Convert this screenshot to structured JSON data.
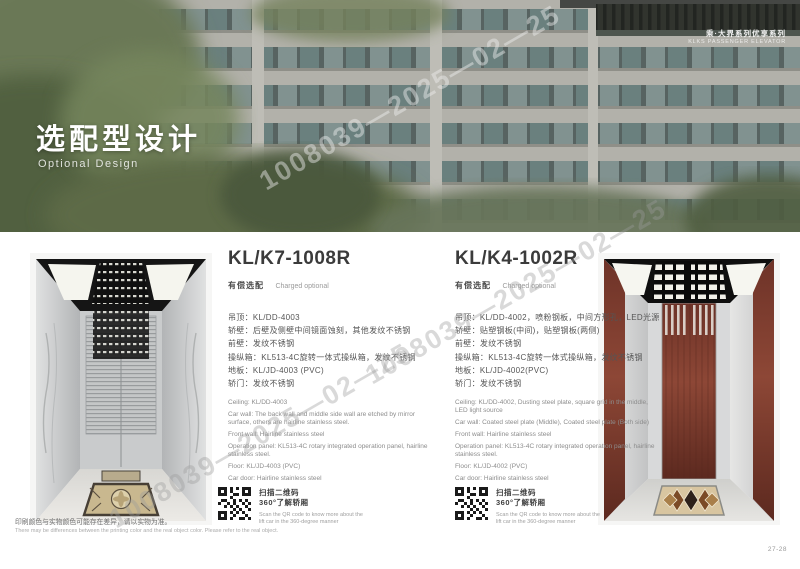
{
  "page": {
    "watermark": "1008039—2025—02—25",
    "page_number": "27-28",
    "disclaimer_zh": "印刷颜色与实物颜色可能存在差异，请以实物为准。",
    "disclaimer_en": "There may be differences between the printing color and the real object color. Please refer to the real object."
  },
  "hero": {
    "title_zh": "选配型设计",
    "title_en": "Optional Design",
    "corner_line1": "乘·大界系列优享系列",
    "corner_line2": "KLKS PASSENGER ELEVATOR"
  },
  "colors": {
    "accent_dark": "#151515",
    "steel_gray": "#c9cbcc",
    "wood_brown": "#7a3a2c",
    "text_dark": "#3b3b3b"
  },
  "products": [
    {
      "model": "KL/K7-1008R",
      "tag_zh": "有偿选配",
      "tag_en": "Charged optional",
      "specs_zh": [
        "吊顶：KL/DD-4003",
        "轿壁：后壁及侧壁中间镜面蚀刻，其他发纹不锈钢",
        "前壁：发纹不锈钢",
        "操纵箱：KL513-4C旋转一体式操纵箱，发纹不锈钢",
        "地板：KL/JD-4003 (PVC)",
        "轿门：发纹不锈钢"
      ],
      "specs_en": [
        "Ceiling: KL/DD-4003",
        "Car wall: The back wall and middle side wall are etched by mirror surface, others are hairline stainless steel.",
        "Front wall: Hairline stainless steel",
        "Operation panel: KL513-4C rotary integrated operation panel, hairline stainless steel.",
        "Floor: KL/JD-4003 (PVC)",
        "Car door: Hairline stainless steel"
      ],
      "qr_zh1": "扫描二维码",
      "qr_zh2": "360°了解轿厢",
      "qr_en": "Scan the QR code to know more about the lift car in the 360-degree manner"
    },
    {
      "model": "KL/K4-1002R",
      "tag_zh": "有偿选配",
      "tag_en": "Charged optional",
      "specs_zh": [
        "吊顶：KL/DD-4002，喷粉钢板，中间方形孔，LED光源",
        "轿壁：贴塑钢板(中间)，贴塑钢板(两侧)",
        "前壁：发纹不锈钢",
        "操纵箱：KL513-4C旋转一体式操纵箱，发纹不锈钢",
        "地板：KL/JD-4002(PVC)",
        "轿门：发纹不锈钢"
      ],
      "specs_en": [
        "Ceiling: KL/DD-4002, Dusting steel plate, square grid in the middle, LED light source",
        "Car wall: Coated steel plate (Middle), Coated steel plate (Both side)",
        "Front wall: Hairline stainless steel",
        "Operation panel: KL513-4C rotary integrated operation panel, hairline stainless steel.",
        "Floor: KL/JD-4002 (PVC)",
        "Car door: Hairline stainless steel"
      ],
      "qr_zh1": "扫描二维码",
      "qr_zh2": "360°了解轿厢",
      "qr_en": "Scan the QR code to know more about the lift car in the 360-degree manner"
    }
  ]
}
